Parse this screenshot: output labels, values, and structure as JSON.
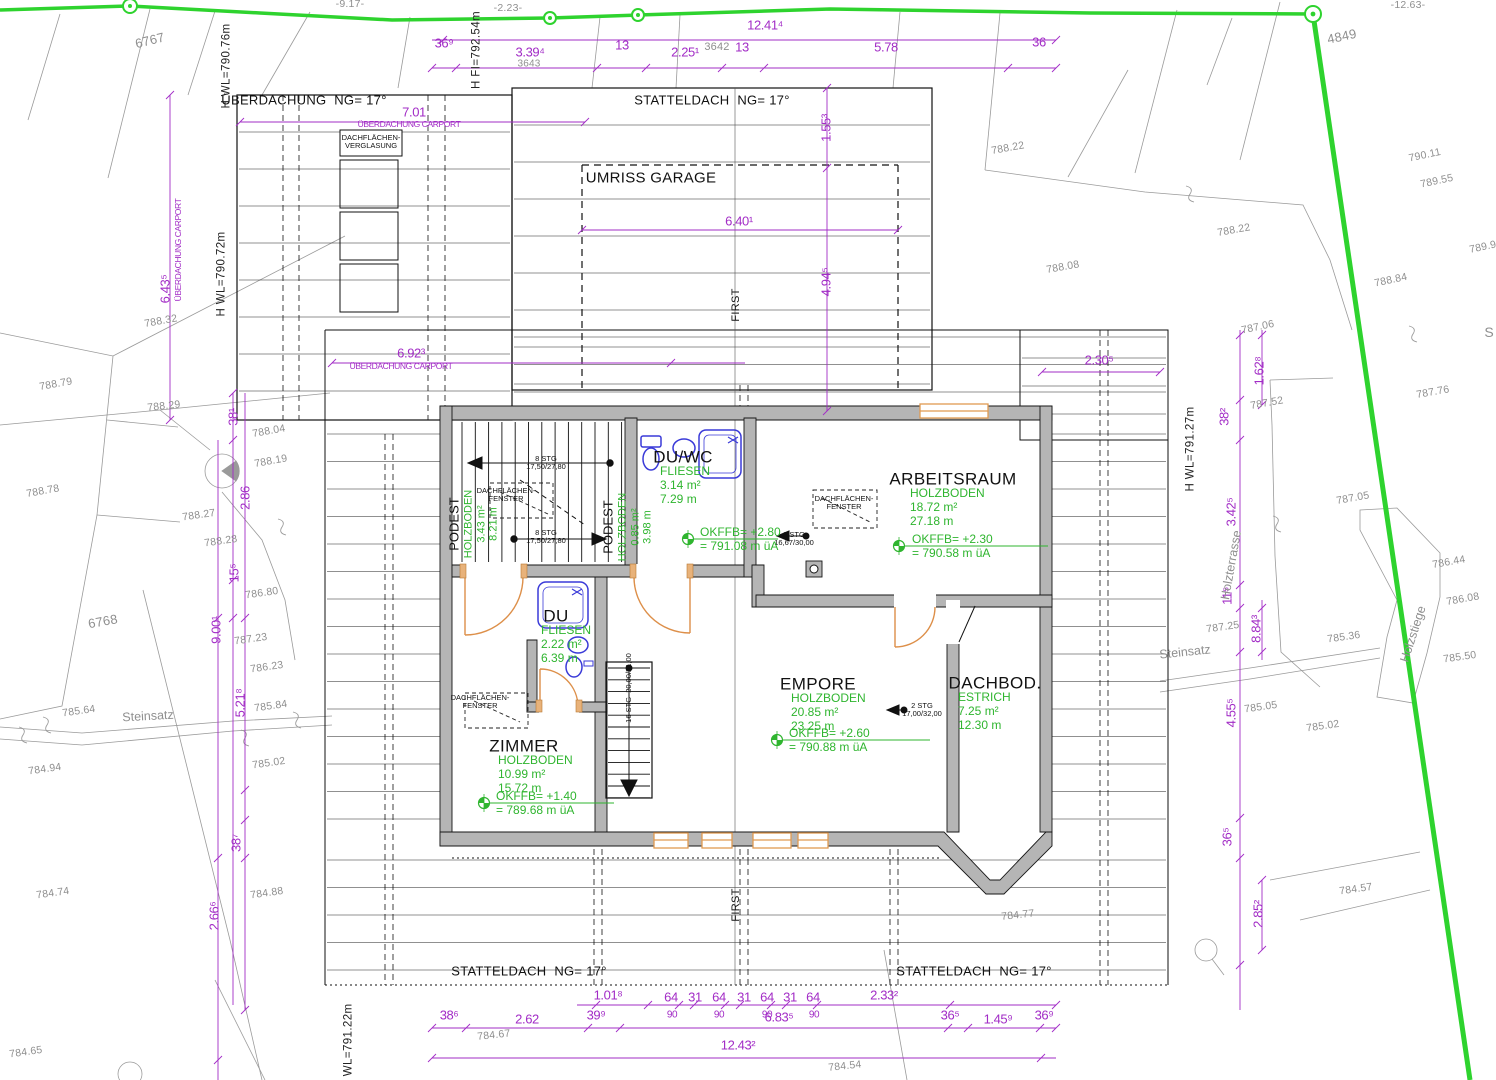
{
  "drawing": {
    "kind": "Dachgeschoss Einreichplan / roof storey plan with site survey",
    "colors": {
      "dimension": "#a22cc6",
      "room_data_green": "#2fb52f",
      "boundary_green": "#2ed32e",
      "survey_gray": "#8f8f8f",
      "wall_fill": "#b5b5b5",
      "sanitary_blue": "#3a3ad8",
      "window_orange": "#e09a52"
    }
  },
  "rooms": [
    {
      "name": "DU/WC",
      "material": "FLIESEN",
      "area": "3.14 m²",
      "perimeter": "7.29 m",
      "nx": 683,
      "ny": 457,
      "bx": 660,
      "by": 465
    },
    {
      "name": "ARBEITSRAUM",
      "material": "HOLZBODEN",
      "area": "18.72 m²",
      "perimeter": "27.18 m",
      "nx": 953,
      "ny": 479,
      "bx": 910,
      "by": 487
    },
    {
      "name": "EMPORE",
      "material": "HOLZBODEN",
      "area": "20.85 m²",
      "perimeter": "23.25 m",
      "nx": 818,
      "ny": 684,
      "bx": 791,
      "by": 692
    },
    {
      "name": "DACHBOD.",
      "material": "ESTRICH",
      "area": "7.25 m²",
      "perimeter": "12.30 m",
      "nx": 995,
      "ny": 683,
      "bx": 958,
      "by": 691
    },
    {
      "name": "ZIMMER",
      "material": "HOLZBODEN",
      "area": "10.99 m²",
      "perimeter": "15.72 m",
      "nx": 524,
      "ny": 746,
      "bx": 498,
      "by": 754
    },
    {
      "name": "DU",
      "material": "FLIESEN",
      "area": "2.22 m²",
      "perimeter": "6.39 m",
      "nx": 556,
      "ny": 616,
      "bx": 541,
      "by": 624
    }
  ],
  "podeste": [
    {
      "name": "PODEST",
      "lines": [
        "HOLZBODEN",
        "3.43 m²",
        "8.21 m"
      ],
      "x": 474,
      "y": 524
    },
    {
      "name": "PODEST",
      "lines": [
        "HOLZBODEN",
        "0.85 m²",
        "3.98 m"
      ],
      "x": 628,
      "y": 527
    }
  ],
  "level_marks": [
    {
      "l1": "OKFFB= +2.80",
      "l2": "= 791.08 m üA",
      "x": 700,
      "y": 526,
      "mx": 688,
      "my": 539,
      "lx": 778
    },
    {
      "l1": "OKFFB= +2.30",
      "l2": "= 790.58 m üA",
      "x": 912,
      "y": 533,
      "mx": 899,
      "my": 546,
      "lx": 1048
    },
    {
      "l1": "OKFFB= +2.60",
      "l2": "= 790.88 m üA",
      "x": 789,
      "y": 727,
      "mx": 777,
      "my": 740,
      "lx": 930
    },
    {
      "l1": "OKFFB= +1.40",
      "l2": "= 789.68 m üA",
      "x": 496,
      "y": 790,
      "mx": 484,
      "my": 803,
      "lx": 614
    }
  ],
  "stairs": [
    {
      "t": "8 STG\n17,50/27,80",
      "x": 546,
      "y": 463
    },
    {
      "t": "8 STG\n17,50/27,80",
      "x": 546,
      "y": 537
    },
    {
      "t": "3 STG\n16,67/30,00",
      "x": 794,
      "y": 539
    },
    {
      "t": "2 STG\n17,00/32,00",
      "x": 922,
      "y": 710
    },
    {
      "t": "16 STG  20,00/21,00",
      "x": 629,
      "y": 688,
      "r": -90
    }
  ],
  "skylights": [
    {
      "t": "DACHFLÄCHEN-\nFENSTER",
      "x": 506,
      "y": 495
    },
    {
      "t": "DACHFLÄCHEN-\nFENSTER",
      "x": 844,
      "y": 503
    },
    {
      "t": "DACHFLÄCHEN-\nFENSTER",
      "x": 480,
      "y": 702
    },
    {
      "t": "DACHFLÄCHEN-\nVERGLASUNG",
      "x": 371,
      "y": 142
    }
  ],
  "annotations": {
    "labels_black": [
      {
        "t": "ÜBERDACHUNG  NG= 17°",
        "x": 304,
        "y": 101
      },
      {
        "t": "STATTELDACH  NG= 17°",
        "x": 712,
        "y": 101
      },
      {
        "t": "UMRISS GARAGE",
        "x": 651,
        "y": 179,
        "s": 15
      },
      {
        "t": "FIRST",
        "x": 736,
        "y": 305,
        "r": -90,
        "s": 11
      },
      {
        "t": "FIRST",
        "x": 736,
        "y": 905,
        "r": -90,
        "s": 11
      },
      {
        "t": "STATTELDACH  NG= 17°",
        "x": 529,
        "y": 972
      },
      {
        "t": "STATTELDACH  NG= 17°",
        "x": 974,
        "y": 972
      }
    ],
    "height_refs": [
      {
        "t": "H WL=790.76m",
        "x": 227,
        "y": 66,
        "r": -90
      },
      {
        "t": "H FI=792.54m",
        "x": 477,
        "y": 50,
        "r": -90
      },
      {
        "t": "H WL=790.72m",
        "x": 222,
        "y": 274,
        "r": -90
      },
      {
        "t": "H WL=791.27m",
        "x": 1191,
        "y": 449,
        "r": -90
      },
      {
        "t": "H WL=791.22m",
        "x": 349,
        "y": 1046,
        "r": -90
      }
    ],
    "site_names": [
      {
        "t": "Steinsatz",
        "x": 148,
        "y": 716,
        "r": -3
      },
      {
        "t": "Steinsatz",
        "x": 1185,
        "y": 652,
        "r": -6
      },
      {
        "t": "Holzterrasse",
        "x": 1231,
        "y": 565,
        "r": -80
      },
      {
        "t": "Holzstiege",
        "x": 1413,
        "y": 634,
        "r": -72
      },
      {
        "t": "S",
        "x": 1489,
        "y": 333,
        "s": 14
      }
    ],
    "dimensions": [
      {
        "t": "12.41⁴",
        "x": 765,
        "y": 26
      },
      {
        "t": "36⁹",
        "x": 444,
        "y": 44
      },
      {
        "t": "3.39⁴",
        "x": 530,
        "y": 53
      },
      {
        "t": "13",
        "x": 622,
        "y": 46
      },
      {
        "t": "2.25¹",
        "x": 685,
        "y": 53
      },
      {
        "t": "13",
        "x": 742,
        "y": 48
      },
      {
        "t": "5.78",
        "x": 886,
        "y": 48
      },
      {
        "t": "36",
        "x": 1039,
        "y": 43
      },
      {
        "t": "7.01",
        "x": 414,
        "y": 113
      },
      {
        "t": "ÜBERDACHUNG CARPORT",
        "x": 409,
        "y": 125,
        "s": 8.5
      },
      {
        "t": "1.55³",
        "x": 827,
        "y": 128,
        "r": -90
      },
      {
        "t": "6.40¹",
        "x": 739,
        "y": 222
      },
      {
        "t": "4.94⁵",
        "x": 827,
        "y": 282,
        "r": -90
      },
      {
        "t": "6.92³",
        "x": 411,
        "y": 354
      },
      {
        "t": "ÜBERDACHUNG CARPORT",
        "x": 401,
        "y": 367,
        "s": 8.5
      },
      {
        "t": "2.30⁵",
        "x": 1099,
        "y": 361
      },
      {
        "t": "6.43⁵",
        "x": 166,
        "y": 289,
        "r": -90
      },
      {
        "t": "ÜBERDACHUNG CARPORT",
        "x": 179,
        "y": 250,
        "r": -90,
        "s": 8.5
      },
      {
        "t": "38¹",
        "x": 234,
        "y": 417,
        "r": -90
      },
      {
        "t": "2.86",
        "x": 246,
        "y": 498,
        "r": -90
      },
      {
        "t": "15⁵",
        "x": 235,
        "y": 573,
        "r": -90
      },
      {
        "t": "9.00¹",
        "x": 217,
        "y": 630,
        "r": -90
      },
      {
        "t": "5.21⁸",
        "x": 241,
        "y": 703,
        "r": -90
      },
      {
        "t": "38⁷",
        "x": 237,
        "y": 843,
        "r": -90
      },
      {
        "t": "2.66⁶",
        "x": 215,
        "y": 916,
        "r": -90
      },
      {
        "t": "1.62⁸",
        "x": 1260,
        "y": 371,
        "r": -90
      },
      {
        "t": "38²",
        "x": 1225,
        "y": 417,
        "r": -90
      },
      {
        "t": "3.42⁵",
        "x": 1232,
        "y": 512,
        "r": -90
      },
      {
        "t": "11⁵",
        "x": 1228,
        "y": 596,
        "r": -90
      },
      {
        "t": "8.84³",
        "x": 1257,
        "y": 629,
        "r": -90
      },
      {
        "t": "4.55⁵",
        "x": 1232,
        "y": 713,
        "r": -90
      },
      {
        "t": "36⁵",
        "x": 1228,
        "y": 837,
        "r": -90
      },
      {
        "t": "2.85²",
        "x": 1259,
        "y": 914,
        "r": -90
      },
      {
        "t": "1.01⁸",
        "x": 608,
        "y": 996
      },
      {
        "t": "64",
        "x": 671,
        "y": 998
      },
      {
        "t": "31",
        "x": 695,
        "y": 998
      },
      {
        "t": "64",
        "x": 719,
        "y": 998
      },
      {
        "t": "31",
        "x": 744,
        "y": 998
      },
      {
        "t": "64",
        "x": 767,
        "y": 998
      },
      {
        "t": "31",
        "x": 790,
        "y": 998
      },
      {
        "t": "64",
        "x": 813,
        "y": 998
      },
      {
        "t": "2.33²",
        "x": 884,
        "y": 996
      },
      {
        "t": "90",
        "x": 672,
        "y": 1015,
        "s": 10
      },
      {
        "t": "90",
        "x": 719,
        "y": 1015,
        "s": 10
      },
      {
        "t": "90",
        "x": 767,
        "y": 1015,
        "s": 10
      },
      {
        "t": "90",
        "x": 814,
        "y": 1015,
        "s": 10
      },
      {
        "t": "38⁶",
        "x": 449,
        "y": 1016
      },
      {
        "t": "2.62",
        "x": 527,
        "y": 1020
      },
      {
        "t": "39⁹",
        "x": 596,
        "y": 1016
      },
      {
        "t": "6.83⁵",
        "x": 779,
        "y": 1018
      },
      {
        "t": "36⁵",
        "x": 950,
        "y": 1016
      },
      {
        "t": "1.45⁹",
        "x": 998,
        "y": 1020
      },
      {
        "t": "36⁹",
        "x": 1044,
        "y": 1016
      },
      {
        "t": "12.43²",
        "x": 738,
        "y": 1046
      }
    ],
    "survey": [
      {
        "t": "-9.17-",
        "x": 350,
        "y": 5,
        "r": 0
      },
      {
        "t": "-2.23-",
        "x": 508,
        "y": 9,
        "r": 0
      },
      {
        "t": "-12.63-",
        "x": 1408,
        "y": 6,
        "r": 0
      },
      {
        "t": "6767",
        "x": 150,
        "y": 41,
        "r": -14,
        "s": 13
      },
      {
        "t": "3643",
        "x": 529,
        "y": 64,
        "s": 10
      },
      {
        "t": "3642",
        "x": 717,
        "y": 47,
        "s": 11
      },
      {
        "t": "4849",
        "x": 1342,
        "y": 37,
        "r": -12,
        "s": 13
      },
      {
        "t": "6768",
        "x": 103,
        "y": 622,
        "r": -10,
        "s": 13
      },
      {
        "t": "788.22",
        "x": 1008,
        "y": 149,
        "r": -10
      },
      {
        "t": "788.22",
        "x": 1234,
        "y": 231,
        "r": -10
      },
      {
        "t": "788.08",
        "x": 1063,
        "y": 268,
        "r": -10
      },
      {
        "t": "788.84",
        "x": 1391,
        "y": 281,
        "r": -12
      },
      {
        "t": "790.11",
        "x": 1425,
        "y": 156,
        "r": -12
      },
      {
        "t": "789.55",
        "x": 1437,
        "y": 182,
        "r": -12
      },
      {
        "t": "789.9",
        "x": 1483,
        "y": 248,
        "r": -12
      },
      {
        "t": "788.32",
        "x": 161,
        "y": 322,
        "r": -10
      },
      {
        "t": "788.79",
        "x": 56,
        "y": 385,
        "r": -10
      },
      {
        "t": "788.29",
        "x": 164,
        "y": 407,
        "r": -6
      },
      {
        "t": "788.04",
        "x": 269,
        "y": 432,
        "r": -10
      },
      {
        "t": "788.19",
        "x": 271,
        "y": 462,
        "r": -10
      },
      {
        "t": "788.78",
        "x": 43,
        "y": 492,
        "r": -10
      },
      {
        "t": "788.27",
        "x": 199,
        "y": 516,
        "r": -8
      },
      {
        "t": "788.28",
        "x": 221,
        "y": 542,
        "r": -8
      },
      {
        "t": "786.80",
        "x": 262,
        "y": 594,
        "r": -8
      },
      {
        "t": "787.23",
        "x": 251,
        "y": 640,
        "r": -8
      },
      {
        "t": "786.23",
        "x": 267,
        "y": 668,
        "r": -8
      },
      {
        "t": "785.84",
        "x": 271,
        "y": 707,
        "r": -8
      },
      {
        "t": "785.64",
        "x": 79,
        "y": 712,
        "r": -8
      },
      {
        "t": "784.94",
        "x": 45,
        "y": 770,
        "r": -8
      },
      {
        "t": "785.02",
        "x": 269,
        "y": 764,
        "r": -8
      },
      {
        "t": "784.74",
        "x": 53,
        "y": 894,
        "r": -8
      },
      {
        "t": "784.88",
        "x": 267,
        "y": 894,
        "r": -8
      },
      {
        "t": "784.65",
        "x": 26,
        "y": 1053,
        "r": -8
      },
      {
        "t": "784.67",
        "x": 494,
        "y": 1036,
        "r": -6
      },
      {
        "t": "784.54",
        "x": 845,
        "y": 1067,
        "r": -6
      },
      {
        "t": "784.77",
        "x": 1018,
        "y": 916,
        "r": -6
      },
      {
        "t": "784.57",
        "x": 1356,
        "y": 890,
        "r": -8
      },
      {
        "t": "787.06",
        "x": 1258,
        "y": 328,
        "r": -12
      },
      {
        "t": "787.52",
        "x": 1267,
        "y": 404,
        "r": -10
      },
      {
        "t": "787.76",
        "x": 1433,
        "y": 393,
        "r": -10
      },
      {
        "t": "787.05",
        "x": 1353,
        "y": 499,
        "r": -10
      },
      {
        "t": "786.44",
        "x": 1449,
        "y": 563,
        "r": -10
      },
      {
        "t": "786.08",
        "x": 1463,
        "y": 600,
        "r": -10
      },
      {
        "t": "785.36",
        "x": 1344,
        "y": 638,
        "r": -8
      },
      {
        "t": "785.50",
        "x": 1460,
        "y": 658,
        "r": -8
      },
      {
        "t": "787.25",
        "x": 1223,
        "y": 628,
        "r": -8
      },
      {
        "t": "785.05",
        "x": 1261,
        "y": 708,
        "r": -8
      },
      {
        "t": "785.02",
        "x": 1323,
        "y": 727,
        "r": -8
      }
    ]
  }
}
